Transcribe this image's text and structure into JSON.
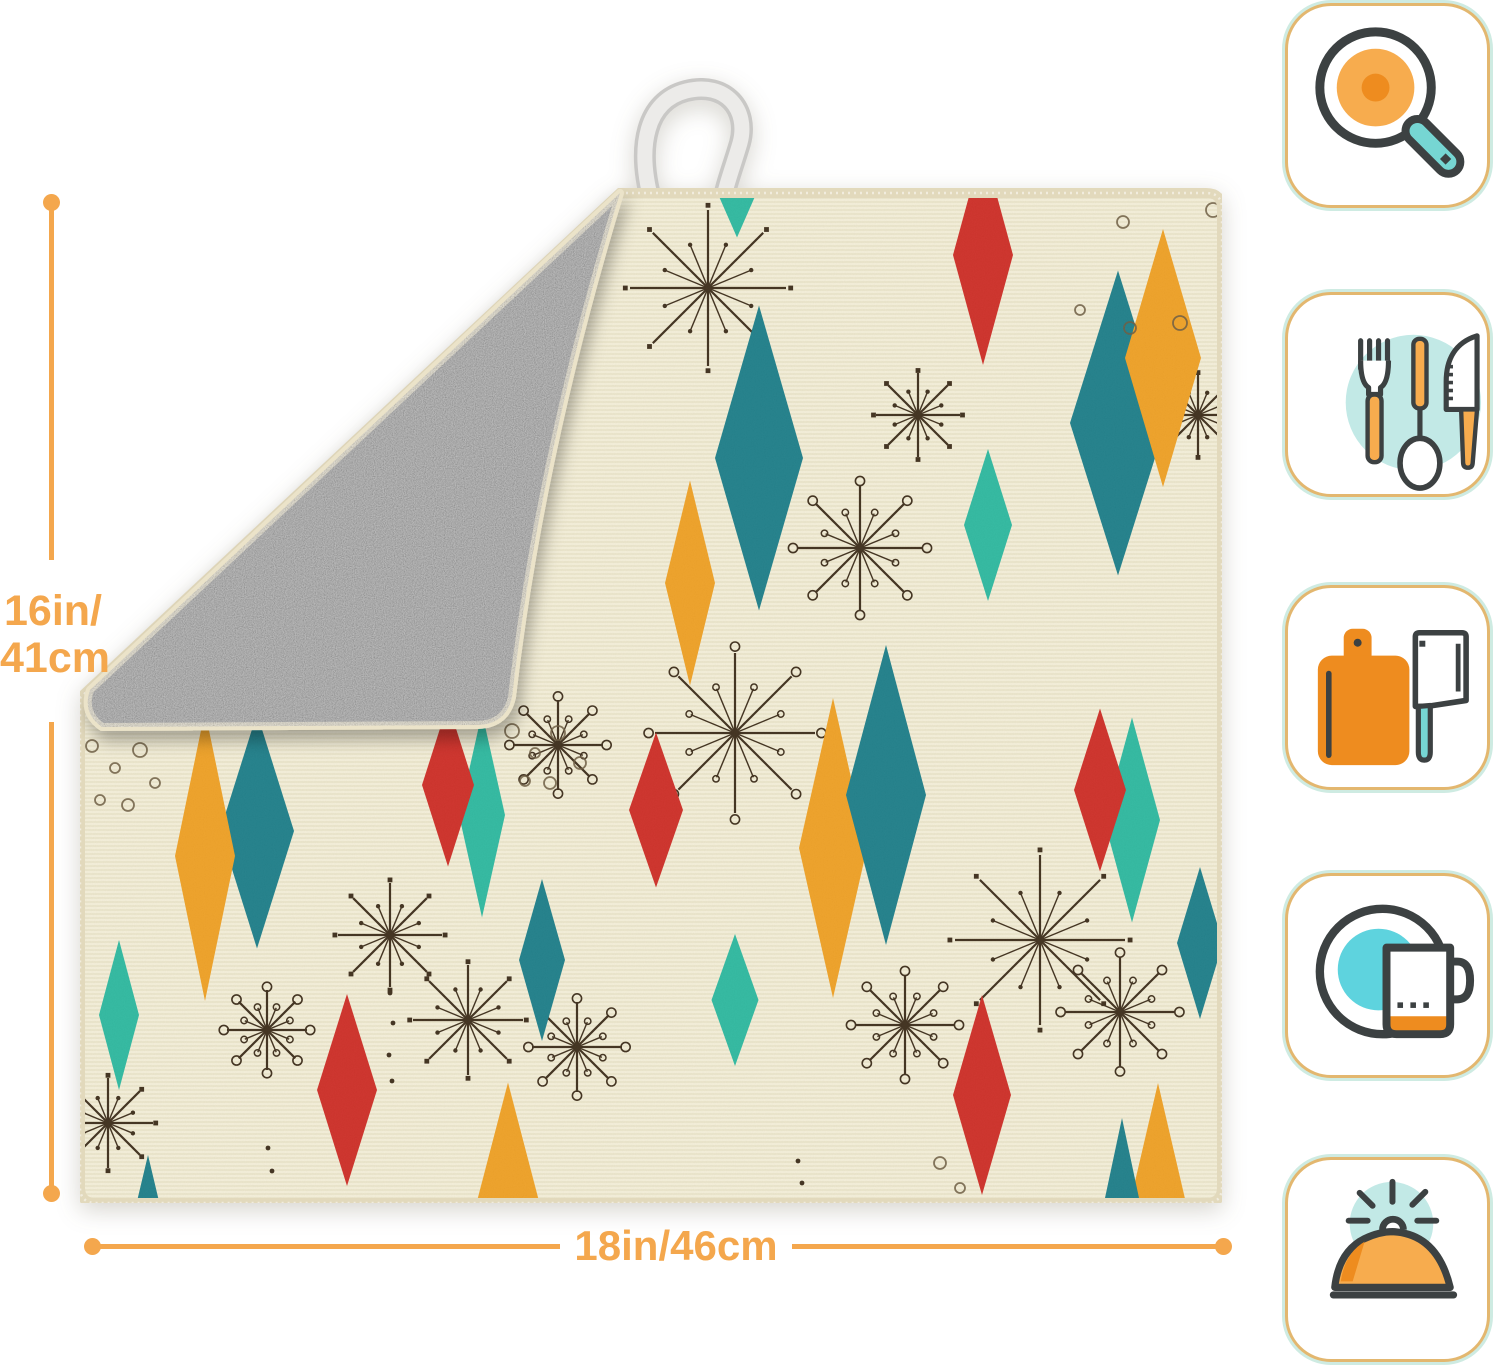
{
  "page": {
    "width": 1500,
    "height": 1365,
    "background": "#FFFFFF"
  },
  "dimensions": {
    "height_label": {
      "line1": "16in/",
      "line2": "41cm"
    },
    "width_label": "18in/46cm"
  },
  "colors": {
    "dim_orange": "#F4A74D",
    "mat_cream": "#F2ECD2",
    "mat_serge": "#E2D9BC",
    "flap_gray": "#949494",
    "flap_edge": "#EBE3C9",
    "loop_outer": "#C9C8C6",
    "loop_inner": "#ECEBE9",
    "diamond_teal": "#1F7F89",
    "diamond_mint": "#2FB9A0",
    "diamond_orange": "#EFA125",
    "diamond_red": "#CE2F28",
    "star_brown": "#3F2F1C",
    "bubble_brown": "#6B5B40",
    "icon_outline": "#3C4142",
    "icon_orange": "#F7AC4E",
    "icon_orange_dark": "#EE8C1F",
    "icon_teal": "#76D6D3",
    "icon_teal_light": "#C2E9E6",
    "icon_plate_teal": "#5ED3DE",
    "icon_border_tan": "#E3B76F",
    "icon_border_mint": "#CEEBE2"
  },
  "icons": [
    {
      "name": "frying-pan-icon"
    },
    {
      "name": "cutlery-icon"
    },
    {
      "name": "cutting-board-icon"
    },
    {
      "name": "dish-mug-icon"
    },
    {
      "name": "serving-cloche-icon"
    }
  ],
  "pattern": {
    "diamonds": [
      {
        "x": 657,
        "y": -8,
        "w": 46,
        "h": 105,
        "c": "mint"
      },
      {
        "x": 679,
        "y": 265,
        "w": 88,
        "h": 305,
        "c": "teal"
      },
      {
        "x": 903,
        "y": 62,
        "w": 60,
        "h": 220,
        "c": "red"
      },
      {
        "x": 1038,
        "y": 230,
        "w": 96,
        "h": 305,
        "c": "teal"
      },
      {
        "x": 1083,
        "y": 165,
        "w": 76,
        "h": 258,
        "c": "orange"
      },
      {
        "x": 908,
        "y": 332,
        "w": 48,
        "h": 152,
        "c": "mint"
      },
      {
        "x": 610,
        "y": 390,
        "w": 50,
        "h": 205,
        "c": "orange"
      },
      {
        "x": 177,
        "y": 638,
        "w": 74,
        "h": 235,
        "c": "teal"
      },
      {
        "x": 125,
        "y": 663,
        "w": 60,
        "h": 290,
        "c": "orange"
      },
      {
        "x": 402,
        "y": 622,
        "w": 46,
        "h": 205,
        "c": "mint"
      },
      {
        "x": 368,
        "y": 592,
        "w": 52,
        "h": 163,
        "c": "red"
      },
      {
        "x": 576,
        "y": 617,
        "w": 54,
        "h": 155,
        "c": "red"
      },
      {
        "x": 753,
        "y": 655,
        "w": 68,
        "h": 300,
        "c": "orange"
      },
      {
        "x": 806,
        "y": 602,
        "w": 80,
        "h": 300,
        "c": "teal"
      },
      {
        "x": 1052,
        "y": 627,
        "w": 56,
        "h": 205,
        "c": "mint"
      },
      {
        "x": 1020,
        "y": 597,
        "w": 52,
        "h": 163,
        "c": "red"
      },
      {
        "x": 39,
        "y": 822,
        "w": 40,
        "h": 150,
        "c": "mint"
      },
      {
        "x": 462,
        "y": 767,
        "w": 46,
        "h": 162,
        "c": "teal"
      },
      {
        "x": 655,
        "y": 807,
        "w": 47,
        "h": 132,
        "c": "mint"
      },
      {
        "x": 1120,
        "y": 750,
        "w": 46,
        "h": 152,
        "c": "teal"
      },
      {
        "x": 267,
        "y": 897,
        "w": 60,
        "h": 192,
        "c": "red"
      },
      {
        "x": 902,
        "y": 902,
        "w": 58,
        "h": 200,
        "c": "red"
      },
      {
        "x": 428,
        "y": 1012,
        "w": 64,
        "h": 245,
        "c": "orange"
      },
      {
        "x": 68,
        "y": 1042,
        "w": 38,
        "h": 160,
        "c": "teal"
      },
      {
        "x": 1078,
        "y": 1010,
        "w": 56,
        "h": 240,
        "c": "orange"
      },
      {
        "x": 1042,
        "y": 1005,
        "w": 34,
        "h": 160,
        "c": "teal"
      }
    ],
    "starbursts": [
      {
        "x": 628,
        "y": 95,
        "r": 78,
        "s": "dots"
      },
      {
        "x": 838,
        "y": 222,
        "r": 42,
        "s": "dots"
      },
      {
        "x": 1118,
        "y": 222,
        "r": 40,
        "s": "dots"
      },
      {
        "x": 780,
        "y": 355,
        "r": 62,
        "s": "rings"
      },
      {
        "x": 655,
        "y": 540,
        "r": 80,
        "s": "rings"
      },
      {
        "x": 310,
        "y": 742,
        "r": 52,
        "s": "dots"
      },
      {
        "x": 187,
        "y": 837,
        "r": 40,
        "s": "rings"
      },
      {
        "x": 388,
        "y": 827,
        "r": 55,
        "s": "dots"
      },
      {
        "x": 497,
        "y": 854,
        "r": 45,
        "s": "rings"
      },
      {
        "x": 960,
        "y": 747,
        "r": 85,
        "s": "dots"
      },
      {
        "x": 1040,
        "y": 819,
        "r": 55,
        "s": "rings"
      },
      {
        "x": 825,
        "y": 832,
        "r": 50,
        "s": "rings"
      },
      {
        "x": 28,
        "y": 930,
        "r": 45,
        "s": "dots"
      },
      {
        "x": 383,
        "y": 477,
        "r": 40,
        "s": "dots"
      },
      {
        "x": 478,
        "y": 552,
        "r": 45,
        "s": "rings"
      },
      {
        "x": 30,
        "y": 485,
        "r": 40,
        "s": "dots"
      }
    ],
    "bubbles": [
      [
        432,
        538,
        7
      ],
      [
        455,
        560,
        5
      ],
      [
        478,
        540,
        7
      ],
      [
        500,
        570,
        6
      ],
      [
        445,
        588,
        5
      ],
      [
        470,
        590,
        6
      ],
      [
        1043,
        29,
        6
      ],
      [
        1133,
        17,
        7
      ],
      [
        1000,
        117,
        5
      ],
      [
        1050,
        135,
        6
      ],
      [
        1100,
        130,
        7
      ],
      [
        1170,
        122,
        5
      ],
      [
        1176,
        65,
        6
      ],
      [
        12,
        553,
        6
      ],
      [
        35,
        575,
        5
      ],
      [
        60,
        557,
        7
      ],
      [
        20,
        607,
        5
      ],
      [
        48,
        612,
        6
      ],
      [
        75,
        590,
        5
      ],
      [
        860,
        970,
        6
      ],
      [
        880,
        995,
        5
      ]
    ],
    "dot_trails": [
      [
        310,
        800
      ],
      [
        313,
        830
      ],
      [
        309,
        862
      ],
      [
        312,
        888
      ],
      [
        718,
        968
      ],
      [
        722,
        990
      ],
      [
        188,
        955
      ],
      [
        192,
        978
      ]
    ]
  }
}
